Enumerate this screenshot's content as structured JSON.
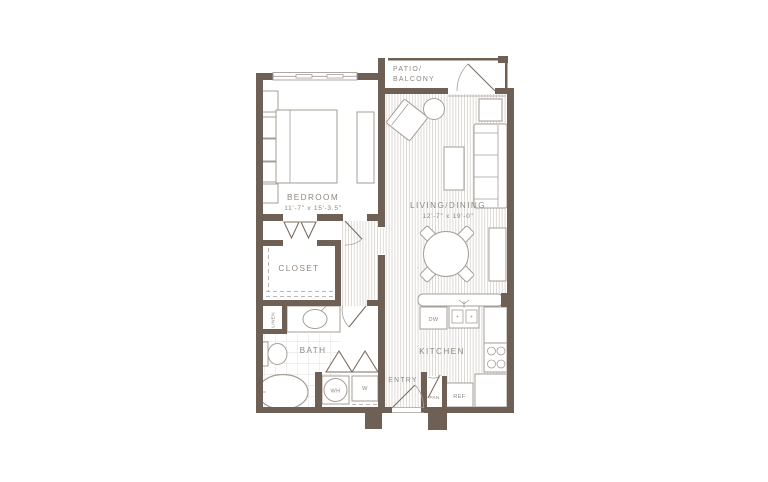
{
  "floorplan": {
    "patio": {
      "label_line1": "PATIO/",
      "label_line2": "BALCONY"
    },
    "bedroom": {
      "label": "BEDROOM",
      "dimensions": "11'-7\" x 15'-3.5\""
    },
    "living_dining": {
      "label": "LIVING/DINING",
      "dimensions": "12'-7\" x 19'-0\""
    },
    "closet": {
      "label": "CLOSET"
    },
    "linen": {
      "label": "LINEN"
    },
    "bath": {
      "label": "BATH"
    },
    "kitchen": {
      "label": "KITCHEN"
    },
    "entry": {
      "label": "ENTRY"
    },
    "appliances": {
      "dishwasher": "DW",
      "water_heater": "WH",
      "washer": "W",
      "pantry": "PAN",
      "refrigerator": "REF"
    },
    "colors": {
      "wall": "#6e6055",
      "furniture_stroke": "#a59e96",
      "hatch_line": "#cfcac4",
      "tile_line": "#d9d5d0",
      "label_text": "#8f8781",
      "background": "#ffffff"
    }
  }
}
